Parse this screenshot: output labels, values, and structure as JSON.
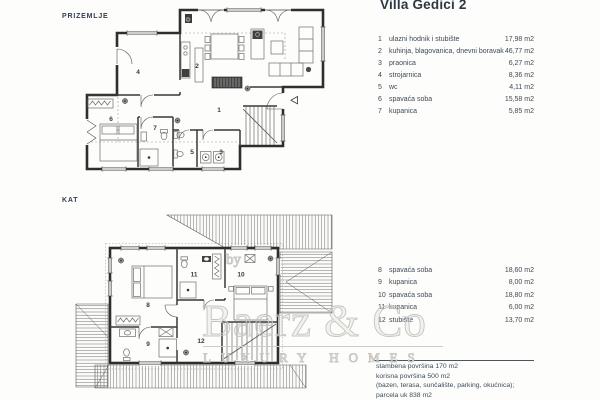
{
  "title": "Villa Gedici 2",
  "ground": {
    "label": "PRIZEMLJE",
    "rooms": [
      {
        "n": "1",
        "name": "ulazni hodnik i stubište",
        "area": "17,98 m2"
      },
      {
        "n": "2",
        "name": "kuhinja, blagovanica, dnevni boravak",
        "area": "46,77 m2"
      },
      {
        "n": "3",
        "name": "praonica",
        "area": "6,27 m2"
      },
      {
        "n": "4",
        "name": "strojarnica",
        "area": "8,36 m2"
      },
      {
        "n": "5",
        "name": "wc",
        "area": "4,11 m2"
      },
      {
        "n": "6",
        "name": "spavaća soba",
        "area": "15,58 m2"
      },
      {
        "n": "7",
        "name": "kupanica",
        "area": "5,85 m2"
      }
    ]
  },
  "upper": {
    "label": "KAT",
    "rooms": [
      {
        "n": "8",
        "name": "spavaća soba",
        "area": "18,60 m2"
      },
      {
        "n": "9",
        "name": "kupanica",
        "area": "8,00 m2"
      },
      {
        "n": "10",
        "name": "spavaća soba",
        "area": "18,80 m2"
      },
      {
        "n": "11",
        "name": "kupanica",
        "area": "6,00 m2"
      },
      {
        "n": "12",
        "name": "stubište",
        "area": "13,70 m2"
      }
    ]
  },
  "summary": {
    "line1": "stambena površina 170 m2",
    "line2": "korisna površina 500 m2",
    "line3": "(bazen, terasa, sunčalište, parking, okućnica);",
    "line4": "parcela uk 838 m2"
  },
  "watermark": {
    "by": "by",
    "name": "Baerz & Co",
    "tagline": "LUXURY HOMES"
  }
}
